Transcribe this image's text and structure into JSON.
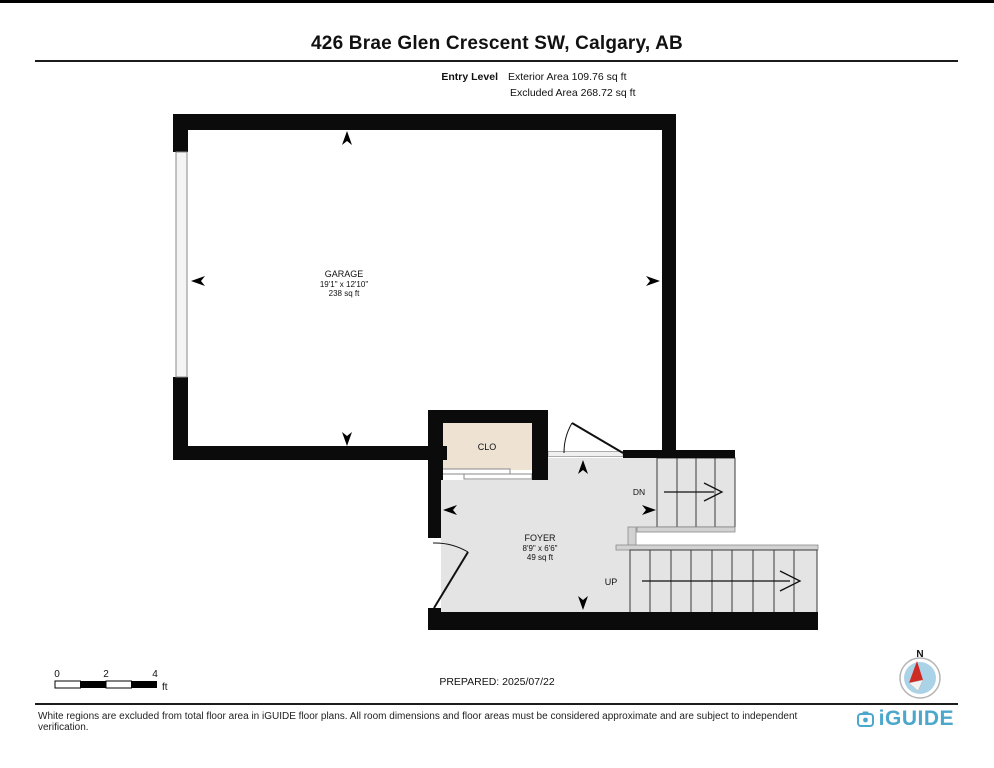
{
  "header": {
    "title": "426 Brae Glen Crescent SW, Calgary, AB",
    "level_label": "Entry Level",
    "exterior_area": "Exterior Area 109.76 sq ft",
    "excluded_area": "Excluded Area 268.72 sq ft"
  },
  "rooms": {
    "garage": {
      "name": "GARAGE",
      "dimensions": "19'1\" x 12'10\"",
      "area": "238 sq ft"
    },
    "closet": {
      "name": "CLO"
    },
    "foyer": {
      "name": "FOYER",
      "dimensions": "8'9\" x 6'6\"",
      "area": "49 sq ft"
    }
  },
  "stairs": {
    "down_label": "DN",
    "up_label": "UP"
  },
  "scale_bar": {
    "tick_0": "0",
    "tick_2": "2",
    "tick_4": "4",
    "unit": "ft"
  },
  "prepared": "PREPARED: 2025/07/22",
  "compass": {
    "north_label": "N"
  },
  "footer": {
    "disclaimer": "White regions are excluded from total floor area in iGUIDE floor plans. All room dimensions and floor areas must be considered approximate and are subject to independent verification.",
    "brand": "iGUIDE"
  },
  "colors": {
    "wall": "#0b0b0b",
    "included_floor": "#e4e4e4",
    "closet_floor": "#eee3d3",
    "brand_blue": "#4ba7cb",
    "compass_red": "#cf2b25"
  }
}
